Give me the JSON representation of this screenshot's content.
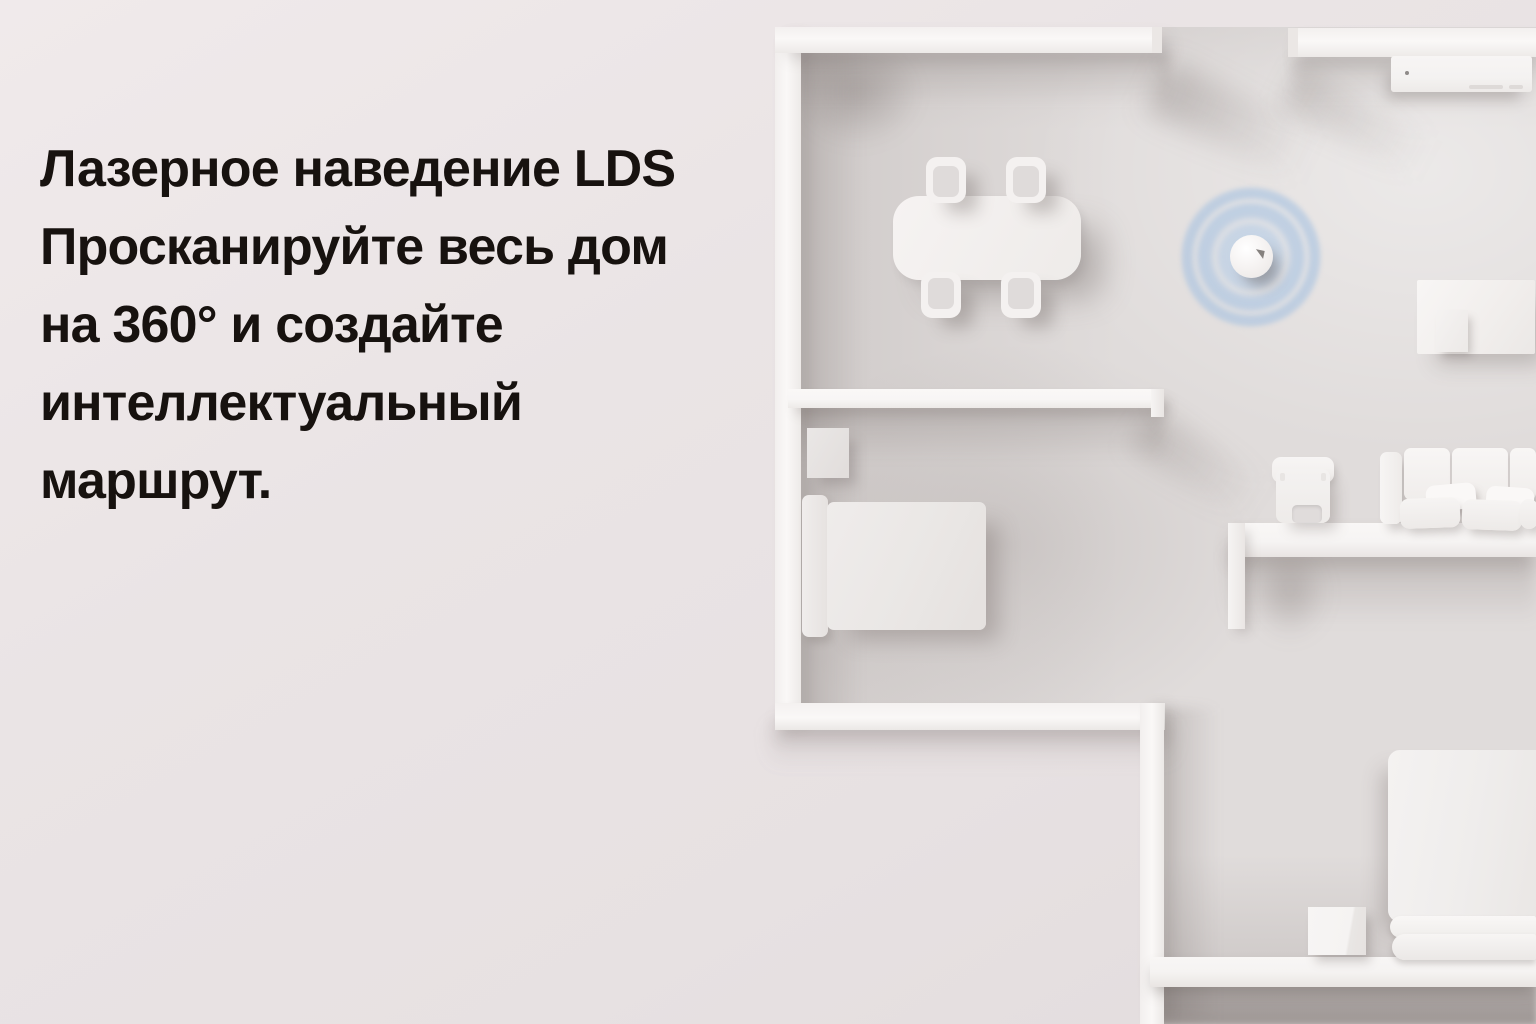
{
  "page": {
    "type": "product-feature-banner",
    "language": "ru"
  },
  "headline": {
    "lines": [
      "Лазерное наведение LDS",
      "Просканируйте весь дом",
      "на 360° и создайте",
      "интеллектуальный",
      "маршрут."
    ]
  },
  "scene": {
    "view": "top-down 3D render of a white apartment floor plan",
    "robot": {
      "label": "robot vacuum emitting 360° LDS scan rings",
      "ring_count": 3,
      "ring_color": "#a9c3e2"
    },
    "objects": [
      "dining table",
      "dining chair",
      "dining chair",
      "dining chair",
      "dining chair",
      "robot vacuum",
      "tv console",
      "side table",
      "small box",
      "armchair",
      "sofa with cushions",
      "single bed",
      "bedside cabinet",
      "double bed with folded blanket",
      "storage cube"
    ],
    "colors": {
      "background": "#eae4e5",
      "floor": "#e0dcdb",
      "wall": "#f8f6f5",
      "headline_text": "#17120f",
      "scan_blue": "#a9c3e2"
    }
  }
}
